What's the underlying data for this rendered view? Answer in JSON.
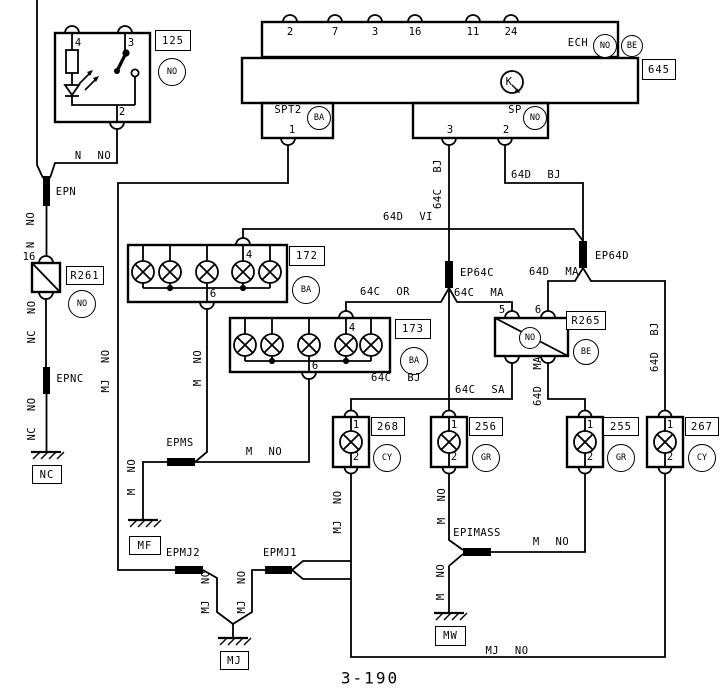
{
  "page": {
    "number": "3-190"
  },
  "components": {
    "ech": {
      "label": "ECH",
      "color": "NO",
      "edge_color": "BE",
      "pins": [
        "2",
        "7",
        "3",
        "16",
        "11",
        "24"
      ]
    },
    "k_unit": {
      "id": "645",
      "symbol": "K"
    },
    "spt2": {
      "label": "SPT2",
      "color": "BA",
      "pin1": "1"
    },
    "sp": {
      "label": "SP",
      "color": "NO",
      "pin3": "3",
      "pin2": "2"
    },
    "sw125": {
      "id": "125",
      "color": "NO",
      "pin4": "4",
      "pin3": "3",
      "pin2": "2"
    },
    "r261": {
      "id": "R261",
      "color": "NO",
      "pin16": "16"
    },
    "r265": {
      "id": "R265",
      "color": "BE",
      "state": "NO",
      "pin5": "5",
      "pin6": "6"
    },
    "b172": {
      "id": "172",
      "color": "BA",
      "pin4": "4",
      "pin6": "6"
    },
    "b173": {
      "id": "173",
      "color": "BA",
      "pin4": "4",
      "pin6": "6"
    },
    "l268": {
      "id": "268",
      "color": "CY",
      "pin1": "1",
      "pin2": "2"
    },
    "l256": {
      "id": "256",
      "color": "GR",
      "pin1": "1",
      "pin2": "2"
    },
    "l255": {
      "id": "255",
      "color": "GR",
      "pin1": "1",
      "pin2": "2"
    },
    "l267": {
      "id": "267",
      "color": "CY",
      "pin1": "1",
      "pin2": "2"
    }
  },
  "splices": {
    "epn": "EPN",
    "epnc": "EPNC",
    "epms": "EPMS",
    "epmj2": "EPMJ2",
    "epmj1": "EPMJ1",
    "epimass": "EPIMASS",
    "ep64c": "EP64C",
    "ep64d": "EP64D"
  },
  "grounds": {
    "nc": "NC",
    "mf": "MF",
    "mj": "MJ",
    "mw": "MW"
  },
  "wires": {
    "n_no": "N NO",
    "nc_no": "NC NO",
    "mj_no": "MJ NO",
    "m_no": "M NO",
    "c64_bj": "64C BJ",
    "c64_or": "64C OR",
    "c64_ma": "64C MA",
    "c64_sa": "64C SA",
    "d64_vi": "64D VI",
    "d64_bj": "64D BJ",
    "d64_ma": "64D MA"
  }
}
